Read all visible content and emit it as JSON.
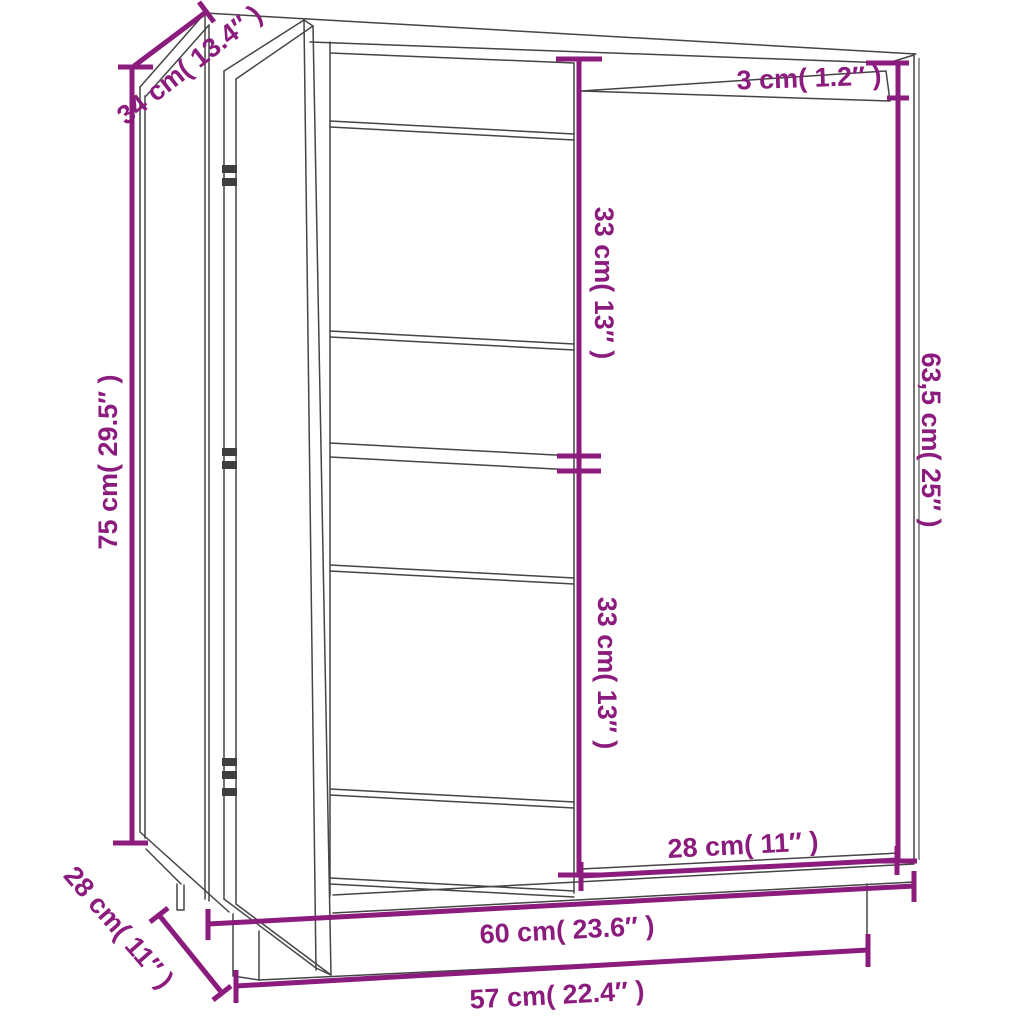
{
  "title": "Cabinet dimension diagram",
  "colors": {
    "dimension_accent": "#8B1B7D",
    "linework": "#454545",
    "background": "#FFFFFF"
  },
  "dims": {
    "depth_top": {
      "label": "34 cm( 13.4″ )",
      "meaning": "top depth"
    },
    "height_left": {
      "label": "75 cm( 29.5″ )",
      "meaning": "overall height"
    },
    "depth_bottom": {
      "label": "28 cm( 11″ )",
      "meaning": "bottom depth"
    },
    "top_thickness": {
      "label": "3 cm( 1.2″ )",
      "meaning": "top panel thickness"
    },
    "shelf_upper": {
      "label": "33 cm( 13″ )",
      "meaning": "upper compartment height"
    },
    "shelf_lower": {
      "label": "33 cm( 13″ )",
      "meaning": "lower compartment height"
    },
    "door_height": {
      "label": "63,5 cm( 25″ )",
      "meaning": "door height"
    },
    "door_width": {
      "label": "28 cm( 11″ )",
      "meaning": "door width"
    },
    "width_top": {
      "label": "60 cm( 23.6″ )",
      "meaning": "cabinet width"
    },
    "width_bottom": {
      "label": "57 cm( 22.4″ )",
      "meaning": "base width"
    }
  }
}
